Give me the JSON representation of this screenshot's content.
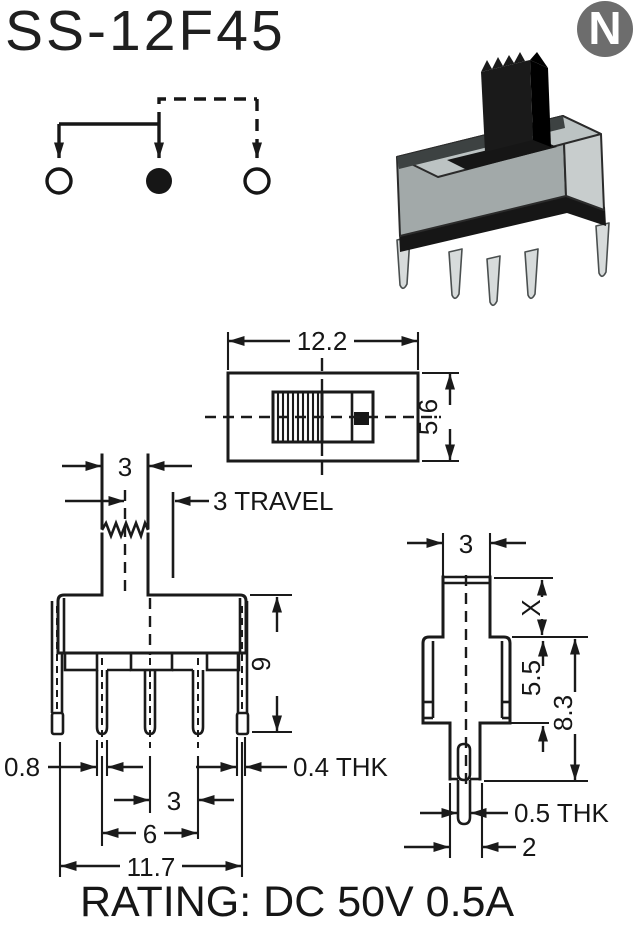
{
  "page": {
    "title": "SS-12F45",
    "logo_letter": "N",
    "rating": "RATING: DC 50V 0.5A"
  },
  "colors": {
    "line": "#1a1a1a",
    "logo_gray": "#6d6d6d",
    "metal_top": "#bcc3c3",
    "metal_front": "#a2a9a9",
    "metal_side": "#c8cdcd",
    "knob_black": "#1a1a1a",
    "pin_fill": "#d7dbdb"
  },
  "schematic": {
    "type": "slide-switch-connection-diagram",
    "positions": [
      "left",
      "common",
      "right"
    ],
    "active_position": "common",
    "solid_path": "common-to-left",
    "dashed_path": "common-to-right"
  },
  "top_view": {
    "width_label": "12.2",
    "height_label": "5.6"
  },
  "front_view": {
    "knob_width_label": "3",
    "travel_label": "3 TRAVEL",
    "height_label": "9",
    "pin_width_label": "0.8",
    "pin_pitch_label": "3",
    "pin_span_label": "6",
    "body_width_label": "11.7",
    "bracket_thickness_label": "0.4 THK"
  },
  "side_view": {
    "knob_width_label": "3",
    "knob_height_label": "X",
    "body_height_label": "5.5",
    "total_height_label": "8.3",
    "pin_thickness_label": "0.5 THK",
    "base_width_label": "2"
  }
}
